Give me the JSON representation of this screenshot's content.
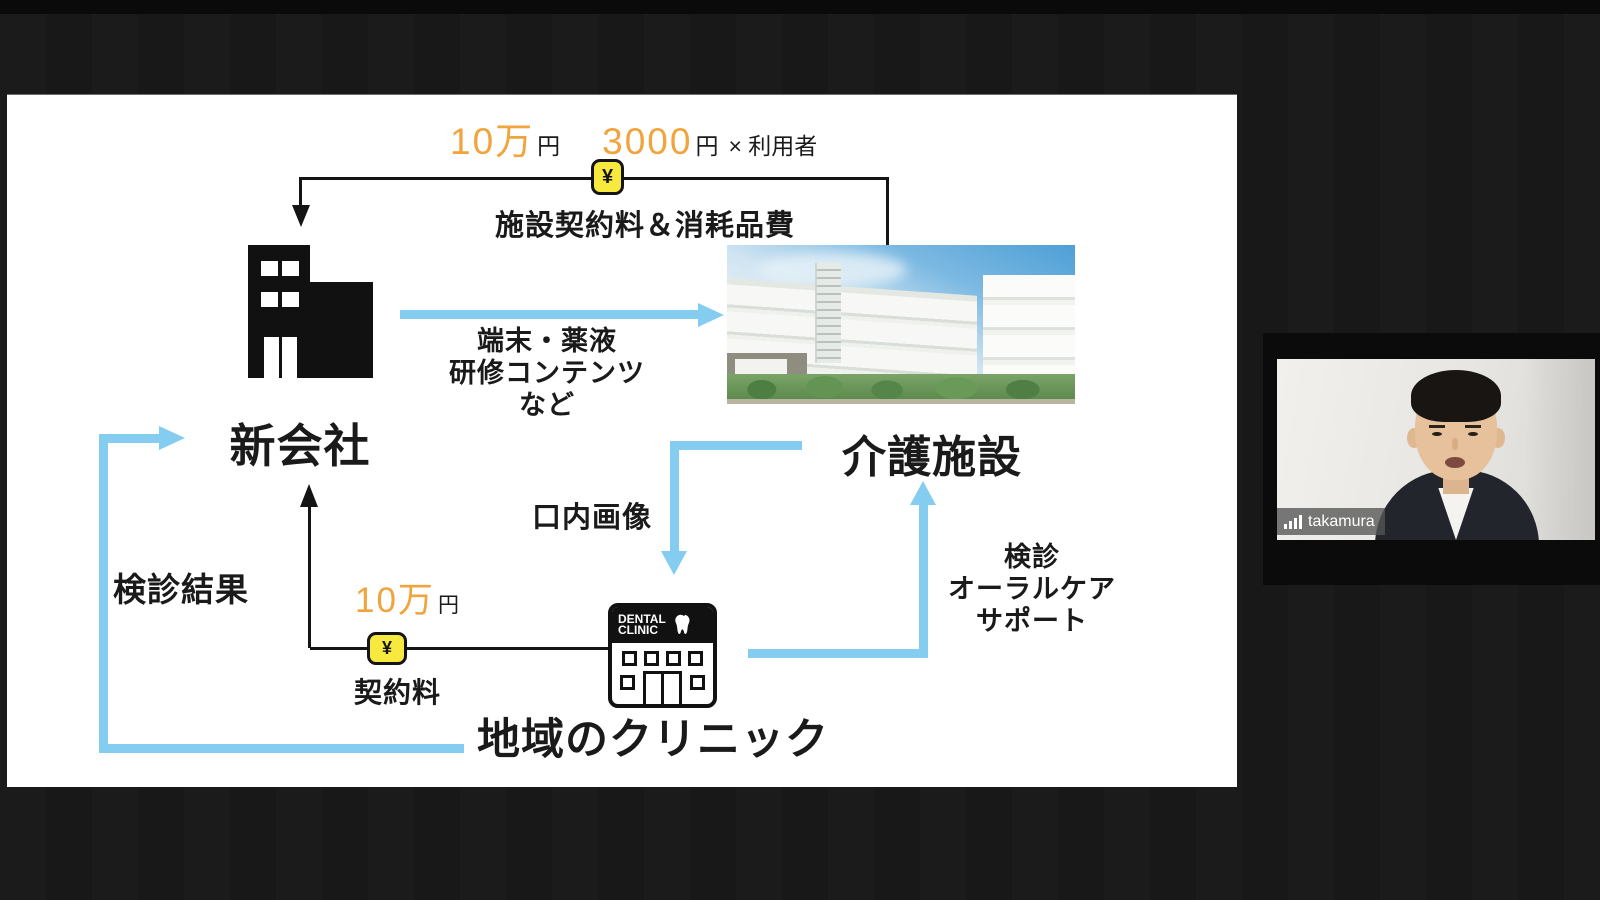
{
  "slide": {
    "fees_top": {
      "facility_fee_amount": "10万",
      "facility_fee_unit": "円",
      "per_user_amount": "3000",
      "per_user_unit": "円",
      "per_user_multiplier": "× 利用者"
    },
    "flow_labels": {
      "facility_contract": "施設契約料＆消耗品費",
      "supplies_line1": "端末・薬液",
      "supplies_line2": "研修コンテンツ",
      "supplies_line3": "など",
      "oral_images": "口内画像",
      "checkup_results": "検診結果",
      "contract_fee_amount": "10万",
      "contract_fee_unit": "円",
      "contract_fee_label": "契約料",
      "support_line1": "検診",
      "support_line2": "オーラルケア",
      "support_line3": "サポート"
    },
    "nodes": {
      "new_company": "新会社",
      "care_facility": "介護施設",
      "local_clinic": "地域のクリニック"
    },
    "clinic_sign_line1": "DENTAL",
    "clinic_sign_line2": "CLINIC",
    "yen_badge": "¥"
  },
  "webcam": {
    "participant_name": "takamura"
  },
  "colors": {
    "orange": "#F1A33C",
    "arrow_blue": "#84CDF0",
    "badge_yellow": "#F8E93F"
  }
}
